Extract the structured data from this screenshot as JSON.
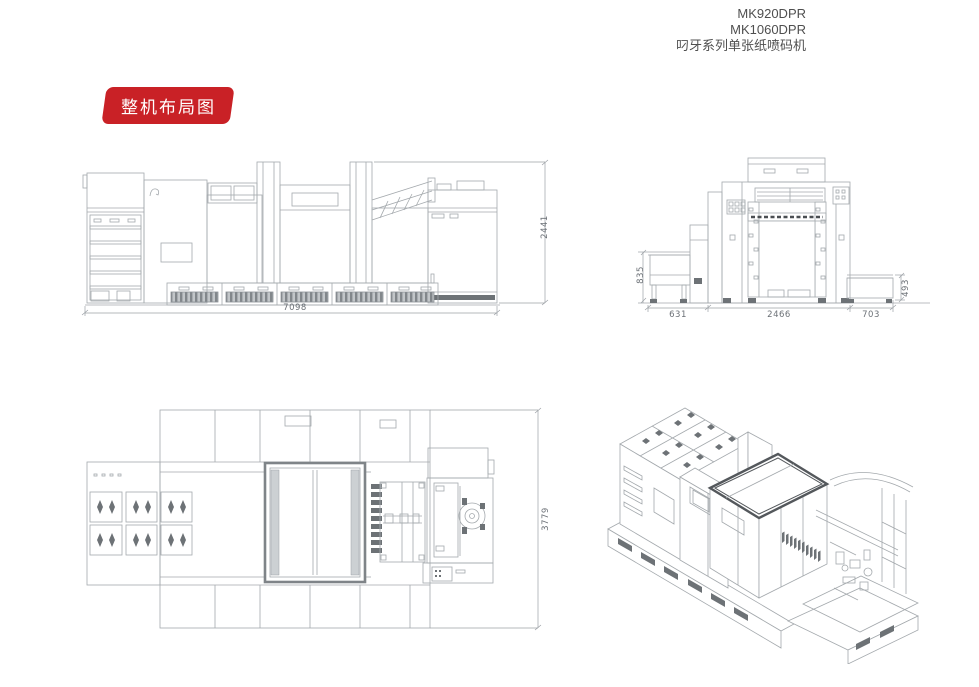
{
  "header": {
    "model_line1": "MK920DPR",
    "model_line2": "MK1060DPR",
    "series_line": "叼牙系列单张纸喷码机"
  },
  "badge": {
    "label": "整机布局图",
    "background_color": "#c92126"
  },
  "colors": {
    "drawing_line": "#a4a9ad",
    "dimension_text": "#6b7076"
  },
  "drawings": {
    "side_view": {
      "dim_width": "7098",
      "dim_height": "2441"
    },
    "front_view": {
      "dim_height_left": "835",
      "dim_width_left": "631",
      "dim_width_center": "2466",
      "dim_width_right": "703",
      "dim_height_right": "493"
    },
    "plan_view": {
      "dim_depth": "3779"
    }
  }
}
